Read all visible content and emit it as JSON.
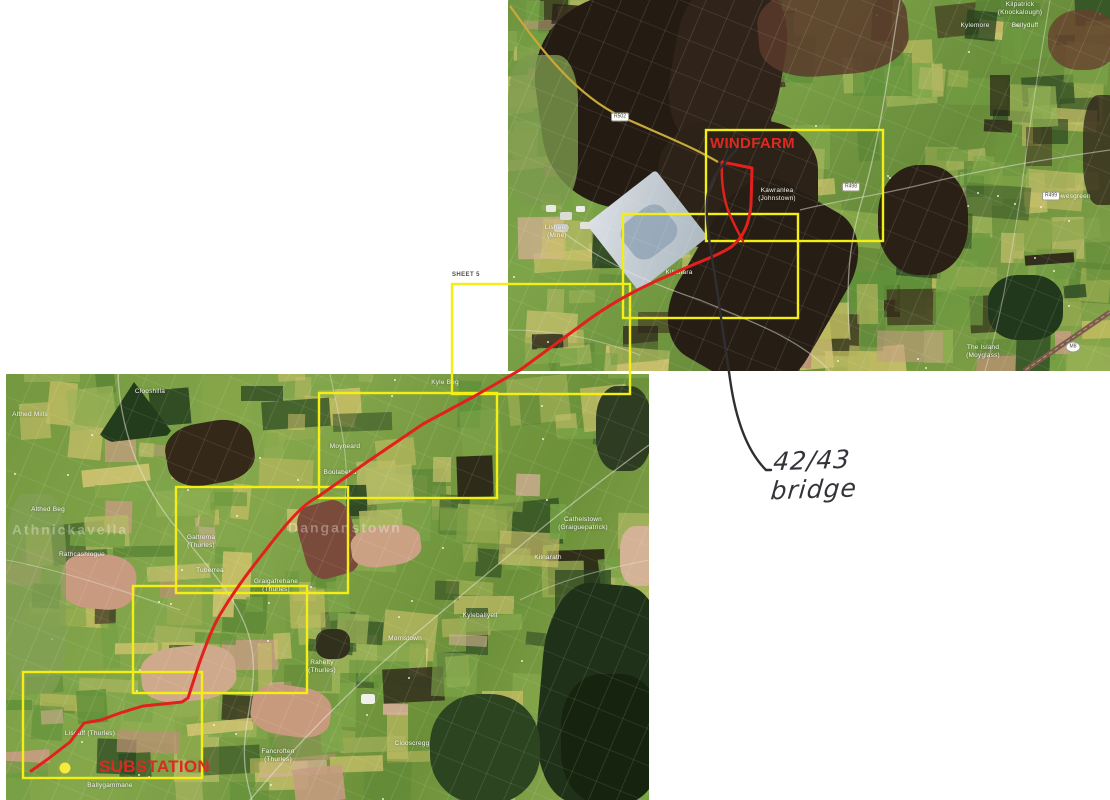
{
  "document": {
    "kind": "scanned aerial route map with sheet index and handwritten note"
  },
  "colors": {
    "paper": "#ffffff",
    "sheet_outline": "#f4ef12",
    "route": "#e2211c",
    "annotation_red": "#dc2a22",
    "pen_ink": "#343339",
    "substation_dot": "#f8ea3a"
  },
  "labels": {
    "windfarm": "WINDFARM",
    "substation": "SUBSTATION",
    "sheet": "SHEET 5",
    "handwritten_note": "42/43 bridge"
  },
  "sheets": [
    {
      "id": "sheet-windfarm",
      "x": 706,
      "y": 130,
      "w": 177,
      "h": 111
    },
    {
      "id": "sheet-2",
      "x": 623,
      "y": 214,
      "w": 175,
      "h": 104
    },
    {
      "id": "sheet-5",
      "x": 452,
      "y": 284,
      "w": 178,
      "h": 110
    },
    {
      "id": "sheet-4",
      "x": 319,
      "y": 393,
      "w": 178,
      "h": 105
    },
    {
      "id": "sheet-3",
      "x": 176,
      "y": 487,
      "w": 172,
      "h": 106
    },
    {
      "id": "sheet-6",
      "x": 133,
      "y": 586,
      "w": 174,
      "h": 107
    },
    {
      "id": "sheet-substation",
      "x": 23,
      "y": 672,
      "w": 179,
      "h": 106
    }
  ],
  "route": {
    "path": "M 722 162 L 752 168 L 751 205 C 749 225 743 238 731 247 C 719 255 701 261 681 270 C 646 285 621 297 591 318 L 520 370 L 473 397 L 423 424 L 367 462 L 319 496 C 310 501 305 505 297 513 C 285 525 272 542 258 560 C 243 579 230 598 221 613 C 212 628 206 645 199 664 L 188 698 L 182 702 L 143 706 L 120 713 L 101 720 L 84 723 L 70 742 L 48 759 L 31 771",
    "windfarm_loop": "M 722 163 C 721 182 724 202 730 215 C 734 224 739 234 743 241"
  },
  "pen_note": {
    "path": "M 737 149 C 721 166 708 181 707 201 C 705 226 713 261 718 296 C 722 326 726 351 730 379 C 735 415 745 449 766 470 L 771 470"
  },
  "top_map": {
    "x": 508,
    "y": 0,
    "w": 602,
    "h": 371,
    "place_labels": [
      {
        "text": "Kilpatrick\n(Knockalough)",
        "x": 1020,
        "y": 9
      },
      {
        "text": "Kylemore",
        "x": 975,
        "y": 26
      },
      {
        "text": "Ballyduff",
        "x": 1025,
        "y": 26
      },
      {
        "text": "Kawranlea\n(Johnstown)",
        "x": 777,
        "y": 195
      },
      {
        "text": "Lowesgreen",
        "x": 1072,
        "y": 197
      },
      {
        "text": "The Island\n(Moyglass)",
        "x": 983,
        "y": 352
      },
      {
        "text": "Lisheen\n(Mine)",
        "x": 557,
        "y": 232
      },
      {
        "text": "Killahara",
        "x": 679,
        "y": 273
      }
    ],
    "road_badges": [
      {
        "text": "R502",
        "x": 620,
        "y": 117,
        "oval": false
      },
      {
        "text": "R498",
        "x": 851,
        "y": 187,
        "oval": false
      },
      {
        "text": "R499",
        "x": 1051,
        "y": 196,
        "oval": false
      },
      {
        "text": "M8",
        "x": 1073,
        "y": 347,
        "oval": true
      }
    ]
  },
  "bottom_map": {
    "x": 6,
    "y": 374,
    "w": 643,
    "h": 426,
    "place_labels": [
      {
        "text": "Clooshilla",
        "x": 150,
        "y": 392
      },
      {
        "text": "Althed Mills",
        "x": 30,
        "y": 415
      },
      {
        "text": "Althed Beg",
        "x": 48,
        "y": 510
      },
      {
        "text": "Athnickavella",
        "x": 70,
        "y": 530,
        "wm": true
      },
      {
        "text": "Rathcashlogue",
        "x": 82,
        "y": 555
      },
      {
        "text": "Moyneard",
        "x": 345,
        "y": 447
      },
      {
        "text": "Boulabeha",
        "x": 340,
        "y": 473
      },
      {
        "text": "Kyle Beg",
        "x": 445,
        "y": 383
      },
      {
        "text": "Galtrema\n(Thurles)",
        "x": 201,
        "y": 542
      },
      {
        "text": "Tuberrea",
        "x": 210,
        "y": 571
      },
      {
        "text": "Graigafrehane\n(Thurles)",
        "x": 276,
        "y": 586
      },
      {
        "text": "Danganstown",
        "x": 345,
        "y": 528,
        "wm": true
      },
      {
        "text": "Cathelstown\n(Graiguepatrick)",
        "x": 583,
        "y": 524
      },
      {
        "text": "Kilnarath",
        "x": 548,
        "y": 558
      },
      {
        "text": "Morristown",
        "x": 405,
        "y": 639
      },
      {
        "text": "Kyleballyell",
        "x": 480,
        "y": 616
      },
      {
        "text": "Rahelty\n(Thurles)",
        "x": 322,
        "y": 667
      },
      {
        "text": "Clooscregg",
        "x": 412,
        "y": 744
      },
      {
        "text": "Fancroften\n(Thurles)",
        "x": 278,
        "y": 756
      },
      {
        "text": "Lisduff (Thurles)",
        "x": 90,
        "y": 734
      },
      {
        "text": "Ballygammane",
        "x": 110,
        "y": 786
      }
    ],
    "marker": {
      "x": 65,
      "y": 768,
      "r": 5.5
    }
  }
}
